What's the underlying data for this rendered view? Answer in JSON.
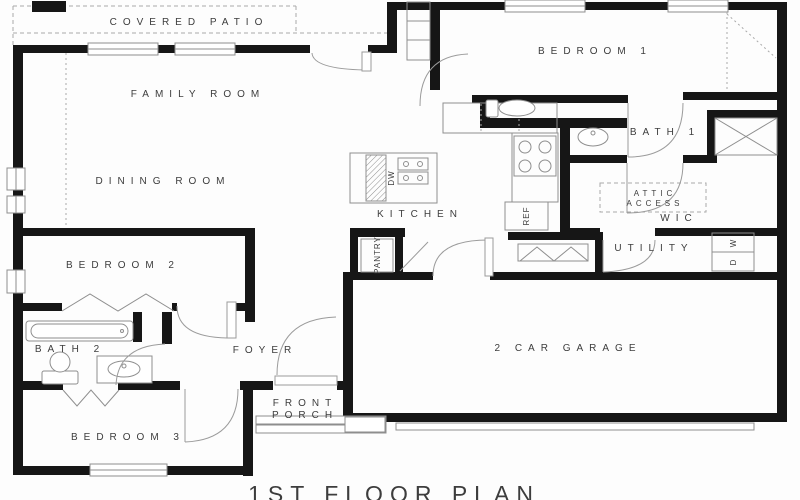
{
  "title": "1ST FLOOR PLAN",
  "rooms": {
    "covered_patio": "COVERED PATIO",
    "family_room": "FAMILY ROOM",
    "dining_room": "DINING ROOM",
    "kitchen": "KITCHEN",
    "pantry": "PANTRY",
    "bedroom_1": "BEDROOM 1",
    "bath_1": "BATH 1",
    "attic_access": {
      "line1": "ATTIC",
      "line2": "ACCESS"
    },
    "wic": "WIC",
    "utility": "UTILITY",
    "bedroom_2": "BEDROOM 2",
    "bath_2": "BATH 2",
    "foyer": "FOYER",
    "front_porch": {
      "line1": "FRONT",
      "line2": "PORCH"
    },
    "bedroom_3": "BEDROOM 3",
    "garage": "2 CAR GARAGE"
  },
  "appliances": {
    "dishwasher": "DW",
    "refrigerator": "REF",
    "washer": "W",
    "dryer": "D"
  },
  "colors": {
    "wall": "#161616",
    "line": "#8e8e8e",
    "dash": "#a9a9a9",
    "text": "#3d3d3d",
    "background": "#fdfdfd"
  }
}
